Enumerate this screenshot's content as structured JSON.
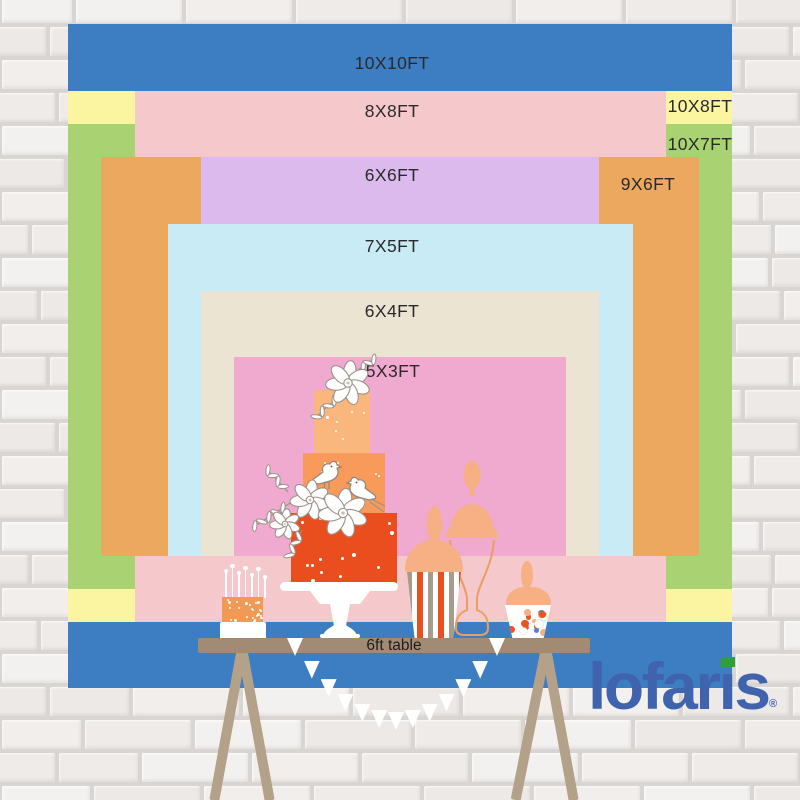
{
  "backdrop": {
    "sizes": [
      {
        "size": "10X10FT",
        "color": "#3d7dc2"
      },
      {
        "size": "10X8FT",
        "color": "#fbf4a0"
      },
      {
        "size": "10X7FT",
        "color": "#a9d273"
      },
      {
        "size": "8X8FT",
        "color": "#f5c8cb"
      },
      {
        "size": "9X6FT",
        "color": "#eca85f"
      },
      {
        "size": "6X6FT",
        "color": "#dcbaee"
      },
      {
        "size": "7X5FT",
        "color": "#c9ebf5"
      },
      {
        "size": "6X4FT",
        "color": "#ebe4d3"
      },
      {
        "size": "5X3FT",
        "color": "#f0a9cf"
      }
    ],
    "label_color": "#2a2a2a"
  },
  "table": {
    "label": "6ft table",
    "top_color": "#a28b74",
    "leg_color": "#b3a18a"
  },
  "brand": {
    "name": "lofaris",
    "registered_mark": "®",
    "color": "#4063ad",
    "i_dot_color": "#2f9e41"
  },
  "scene": {
    "wall": "white-brick-wall",
    "cake": {
      "tier_colors": [
        "#f9b77d",
        "#f79a5a",
        "#ea4e1f"
      ],
      "stand_color": "#ffffff"
    },
    "small_cake": {
      "color": "#f09a55",
      "candle_count": 7
    },
    "popcorn_jar": {
      "lid_color": "#f6b083",
      "stripe_colors": [
        "#a59c8c",
        "#ffffff",
        "#e85020"
      ]
    },
    "candy_jar": {
      "lid_color": "#f6b083",
      "candy_colors": [
        "#e85525",
        "#f2b185",
        "#ffffff",
        "#5c7fd0"
      ]
    },
    "glass_jar": {
      "outline_color": "#eb9e63",
      "lid_color": "#f6b083"
    },
    "bunting": {
      "color": "#ffffff",
      "flag_count": 13
    }
  }
}
